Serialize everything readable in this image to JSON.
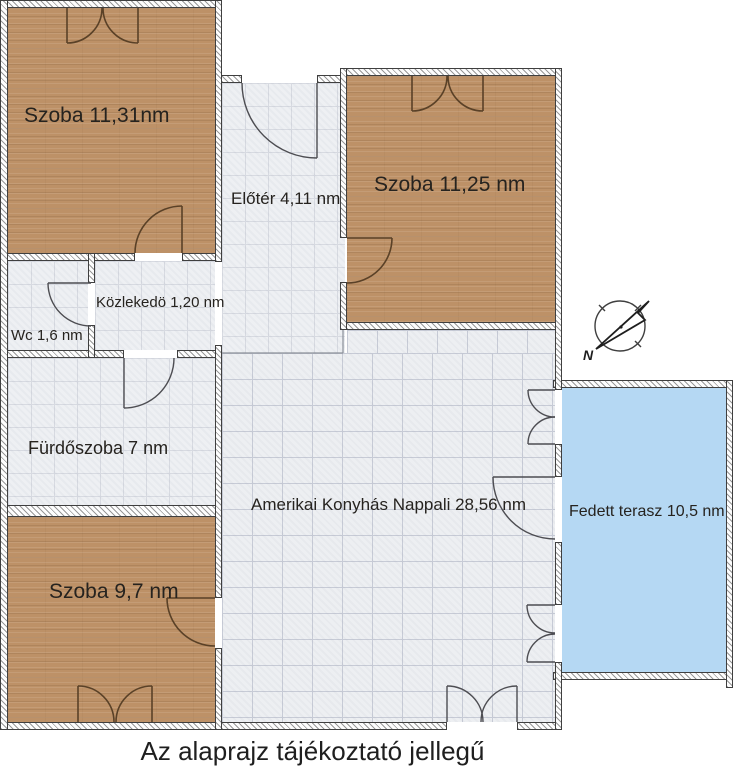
{
  "rooms": {
    "szoba1": {
      "label": "Szoba 11,31nm"
    },
    "szoba2": {
      "label": "Szoba 11,25 nm"
    },
    "eloter": {
      "label": "Előtér 4,11 nm"
    },
    "kozlekedo": {
      "label": "Közlekedö 1,20 nm"
    },
    "wc": {
      "label": "Wc 1,6 nm"
    },
    "furdoszoba": {
      "label": "Fürdőszoba 7 nm"
    },
    "nappali": {
      "label": "Amerikai Konyhás Nappali 28,56 nm"
    },
    "szoba3": {
      "label": "Szoba 9,7 nm"
    },
    "terasz": {
      "label": "Fedett terasz 10,5 nm"
    }
  },
  "compass": {
    "label": "N"
  },
  "page": {
    "footer": "Az alaprajz tájékoztató jellegű"
  },
  "colors": {
    "wood_floor": "#bd9167",
    "tile_floor": "#eef0f3",
    "terrace": "#b5d8f3",
    "wall_outline": "#3f3f3f",
    "door_brown": "#5a4127",
    "door_gray": "#4d4d52",
    "text": "#26231f"
  }
}
